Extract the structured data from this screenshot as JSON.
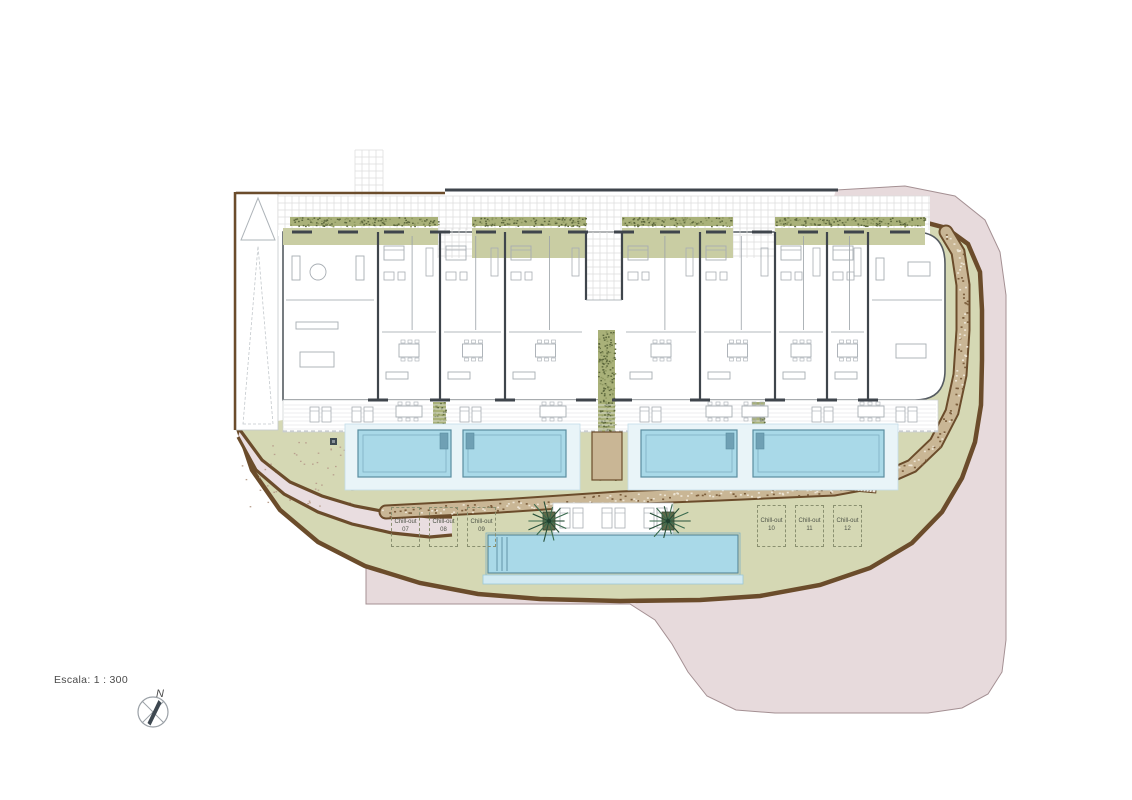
{
  "legend": {
    "scale_label": "Escala: 1 : 300"
  },
  "compass": {
    "north_label": "N"
  },
  "chill_out_zones": {
    "left": [
      {
        "label": "Chill-out",
        "number": "07"
      },
      {
        "label": "Chill-out",
        "number": "08"
      },
      {
        "label": "Chill-out",
        "number": "09"
      }
    ],
    "right": [
      {
        "label": "Chill-out",
        "number": "10"
      },
      {
        "label": "Chill-out",
        "number": "11"
      },
      {
        "label": "Chill-out",
        "number": "12"
      }
    ]
  },
  "palette": {
    "terrain_pink": "#e7dadc",
    "terrain_pink_edge": "#a49093",
    "landscape_green": "#d5d8b4",
    "roof_olive": "#c9cda3",
    "hedge_green": "#a9b179",
    "hedge_dot": "#5c673c",
    "wall_brown": "#6b4c2b",
    "stone_tan": "#c9b695",
    "stone_dot_dark": "#7c5e3c",
    "stone_dot_light": "#ece4d4",
    "pool_blue": "#a9d9e8",
    "pool_edge": "#5a8da0",
    "pool_line": "#7fb0c2",
    "pool_deck": "#e9f4f8",
    "pool_rim": "#d2eaf2",
    "wall_dark": "#3f454c",
    "wall_outline": "#555b61",
    "wall_thin": "#9aa1a7",
    "furniture": "#a7adb3",
    "grid_line": "#dcdcdc",
    "palm_green": "#3a6b4e",
    "text": "#4a4a4a"
  }
}
